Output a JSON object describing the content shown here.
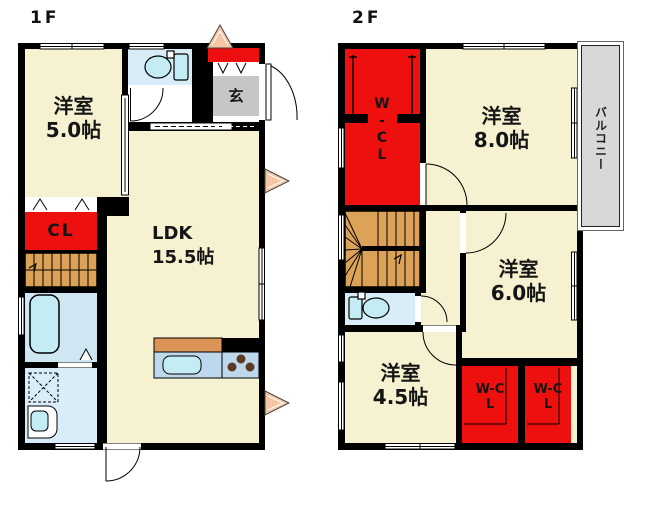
{
  "colors": {
    "wall": "#000000",
    "cream": "#F6F1D1",
    "red": "#EE0F0F",
    "stairs": "#DCA258",
    "gray": "#C6C6C6",
    "balcony": "#D8D8D8",
    "tblue": "#D9EDF8",
    "bblue": "#CEE7F2",
    "wblue": "#D9EDF8",
    "tub": "#C3ECF4",
    "counterTop": "#DB9356",
    "counterBody": "#BDD8ED",
    "burner": "#5C3A21",
    "arrow": "#F4C6A4",
    "window": "#FFFFFF"
  },
  "floor1": {
    "title": "1F",
    "rooms": {
      "yoshitsu5": {
        "name": "洋室",
        "size": "5.0帖"
      },
      "ldk": {
        "name": "LDK",
        "size": "15.5帖"
      },
      "closet": {
        "label": "CL"
      },
      "genkan": {
        "label": "玄"
      }
    }
  },
  "floor2": {
    "title": "2F",
    "rooms": {
      "wicl": {
        "label": "W-CL"
      },
      "yoshitsu8": {
        "name": "洋室",
        "size": "8.0帖"
      },
      "balcony": {
        "label": "バルコニー"
      },
      "yoshitsu6": {
        "name": "洋室",
        "size": "6.0帖"
      },
      "yoshitsu45": {
        "name": "洋室",
        "size": "4.5帖"
      },
      "wclLeft": {
        "label": "W-CL"
      },
      "wclRight": {
        "label": "W-CL"
      }
    }
  }
}
